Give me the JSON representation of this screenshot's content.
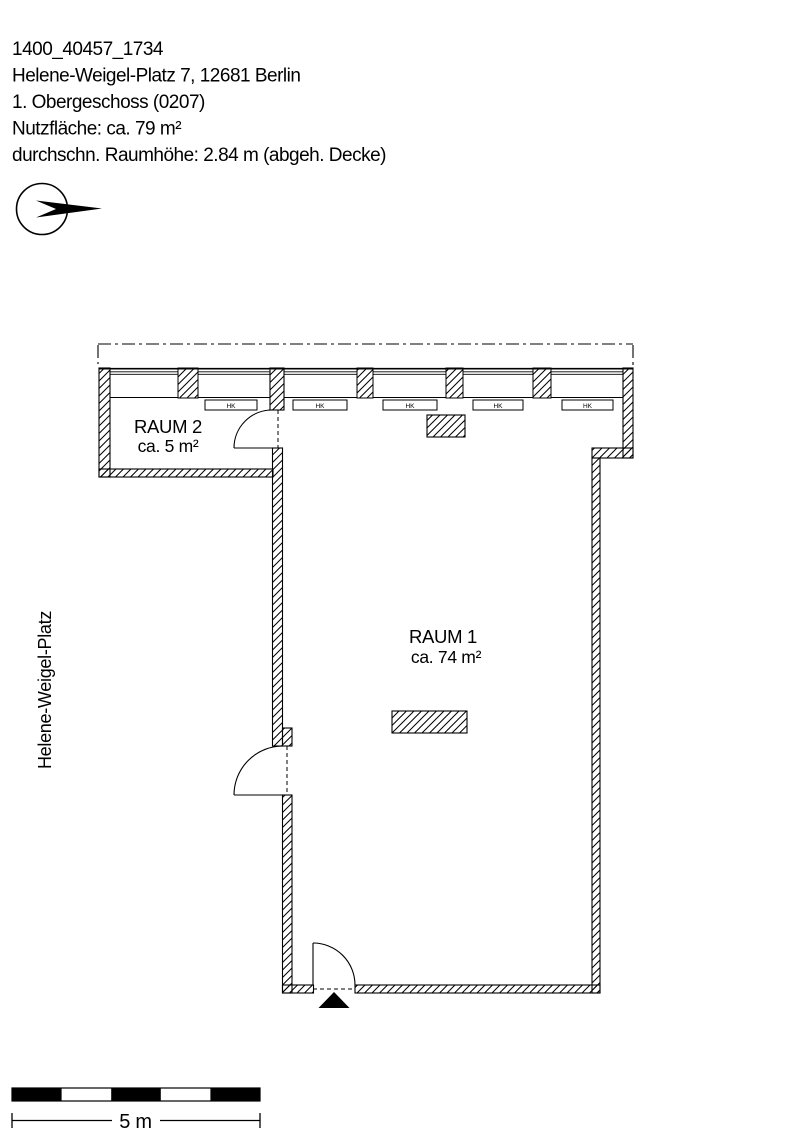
{
  "document": {
    "project_id": "1400_40457_1734",
    "address": "Helene-Weigel-Platz 7, 12681 Berlin",
    "floor": "1. Obergeschoss (0207)",
    "usable_area": "Nutzfläche: ca. 79 m²",
    "room_height": "durchschn. Raumhöhe: 2.84 m (abgeh. Decke)"
  },
  "plan": {
    "street_label": "Helene-Weigel-Platz",
    "rooms": [
      {
        "name": "RAUM 1",
        "area": "ca. 74 m²"
      },
      {
        "name": "RAUM 2",
        "area": "ca. 5 m²"
      }
    ],
    "radiator_label": "HK",
    "scale_label": "5 m"
  },
  "colors": {
    "ink": "#000000",
    "paper": "#ffffff"
  }
}
